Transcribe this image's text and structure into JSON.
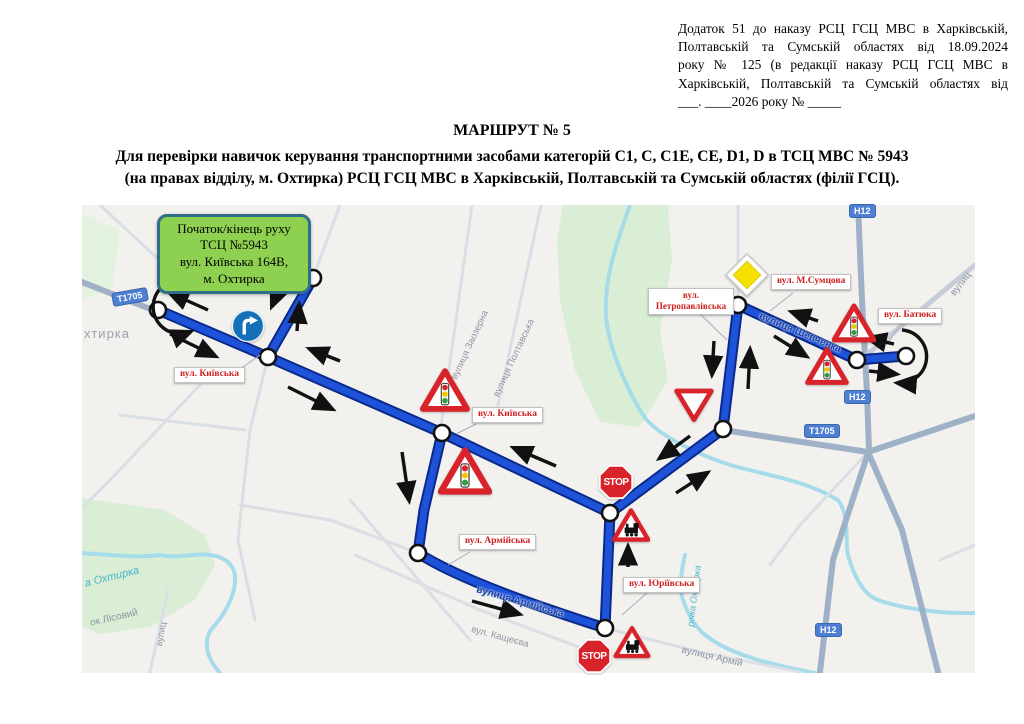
{
  "header": {
    "annex_lines": [
      "Додаток 51 до наказу РСЦ ГСЦ МВС в Харківській,",
      "Полтавській та Сумській областях від 18.09.2024",
      "року № 125 (в редакції наказу РСЦ ГСЦ МВС в",
      "Харківській, Полтавській та Сумській областях від",
      "___. ____2026 року № _____"
    ]
  },
  "title": {
    "line1": "МАРШРУТ № 5",
    "line2": "Для перевірки навичок керування транспортними засобами категорій С1, С, С1Е, СЕ, D1, D в ТСЦ МВС № 5943",
    "line3": "(на правах відділу, м. Охтирка) РСЦ ГСЦ МВС в Харківській, Полтавській та Сумській областях (філії ГСЦ)."
  },
  "map": {
    "start_box": {
      "lines": [
        "Початок/кінець руху",
        "ТСЦ №5943",
        "вул. Київська 164В,",
        "м. Охтирка"
      ]
    },
    "route_labels": [
      {
        "text": "вул. Київська"
      },
      {
        "text": "вул. Київська"
      },
      {
        "text": "вул. Армійська"
      },
      {
        "text": "вул. Юріївська"
      },
      {
        "text": "вул. Петропавлівська"
      },
      {
        "text": "вул. М.Сумцова"
      },
      {
        "text": "вул. Батюка"
      }
    ],
    "street_names": [
      {
        "text": "хтирка"
      },
      {
        "text": "вулиця Заозерна"
      },
      {
        "text": "вулиця Полтавська"
      },
      {
        "text": "вулиця Шевченка"
      },
      {
        "text": "вулиця Армійська"
      },
      {
        "text": "вул. Кащеєва"
      },
      {
        "text": "вулиця Армій"
      },
      {
        "text": "річка Охтирка"
      },
      {
        "text": "а Охтирка"
      },
      {
        "text": "ок Лісовий"
      },
      {
        "text": "вулиц"
      },
      {
        "text": "вулиц"
      }
    ],
    "road_shields": [
      {
        "text": "Т1705"
      },
      {
        "text": "Н12"
      },
      {
        "text": "Н12"
      },
      {
        "text": "Т1705"
      },
      {
        "text": "Н12"
      }
    ],
    "stop_text": "STOP",
    "icons": {
      "mandatory_right_turn": "blue circle with white right-turn arrow",
      "traffic_lights_warning": "red triangle with traffic light",
      "railway_crossing_warning": "red triangle with steam locomotive",
      "give_way": "inverted red-bordered triangle",
      "priority_road": "yellow diamond",
      "stop": "red octagon STOP",
      "u_turn_loop": "black looped arrow"
    }
  },
  "colors": {
    "route": "#1e52d8",
    "route_border": "#0a2a8a",
    "label_text": "#cc1f1f",
    "green_box_bg": "#8ed050",
    "green_box_border": "#2f6f8a",
    "shield_bg": "#4f7fd2",
    "stop_red": "#d8232a",
    "sign_red": "#d8232a",
    "map_bg": "#f3f1ee"
  }
}
